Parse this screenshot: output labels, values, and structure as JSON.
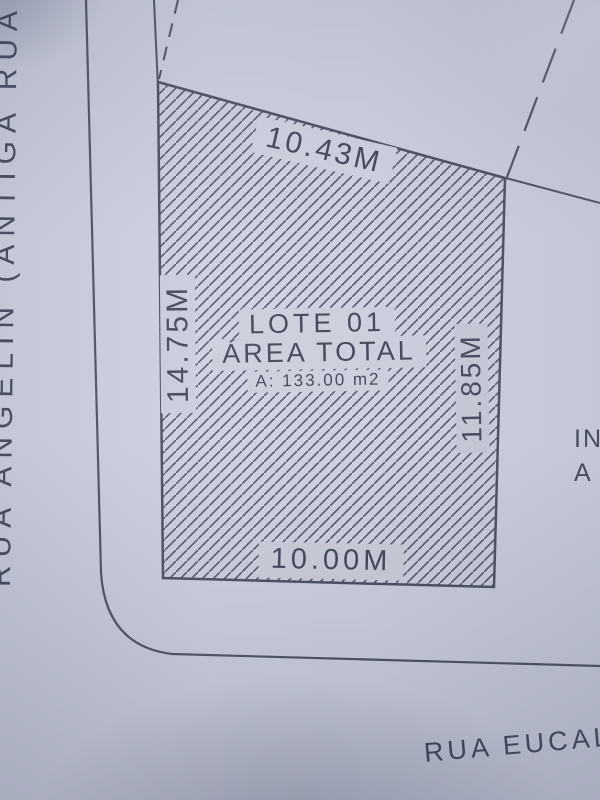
{
  "plan": {
    "lot": {
      "name": "LOTE 01",
      "area_label": "ÁREA TOTAL",
      "area_value": "A: 133.00 m2"
    },
    "dimensions": {
      "top": "10.43M",
      "left": "14.75M",
      "right": "11.85M",
      "bottom": "10.00M"
    },
    "streets": {
      "left": "RUA ANGELIN (ANTIGA RUA",
      "bottom_right": "RUA EUCALIP"
    },
    "adjacent_label": {
      "line1": "IN",
      "line2": "A"
    },
    "colors": {
      "paper": "#ccd0df",
      "ink": "#3d4355",
      "hatch_line": "#4d5265"
    }
  }
}
